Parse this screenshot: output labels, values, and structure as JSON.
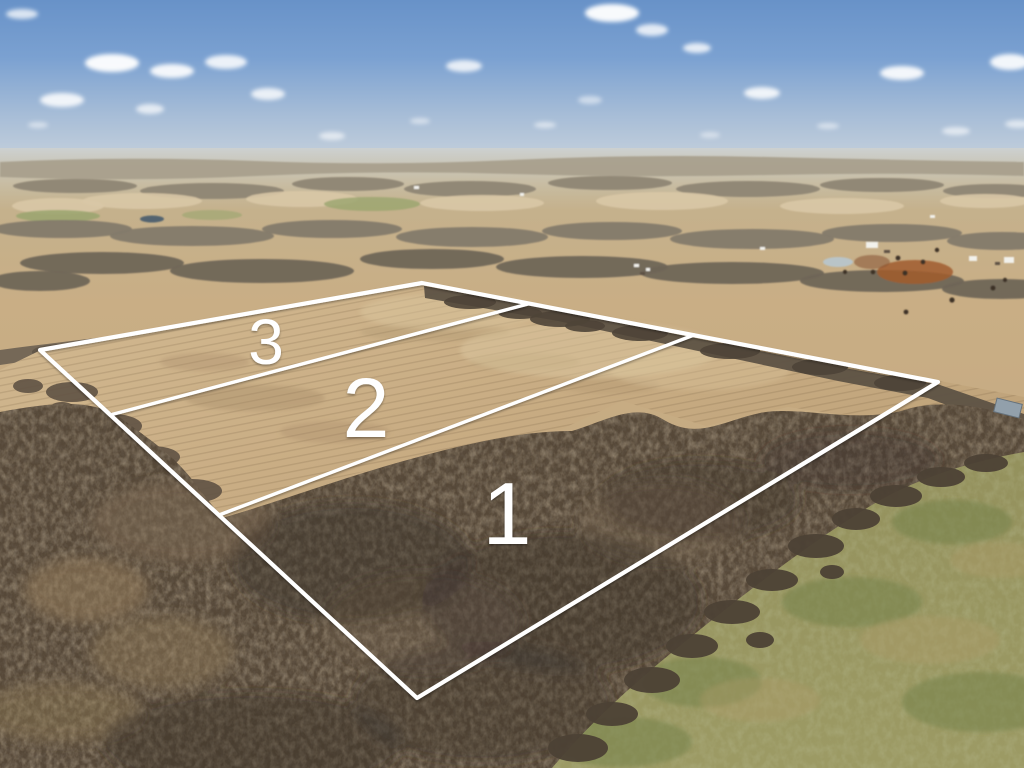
{
  "photo": {
    "kind": "aerial-drone-photograph",
    "subject": "rural farmland with surveyed lot lines marking three parcels",
    "season": "late winter, bare trees"
  },
  "overlay": {
    "line_color": "#ffffff",
    "label_color": "#ffffff",
    "outer_boundary_points": "40,350 422,283 938,382 417,698",
    "divider_3_2_points": "110,415 528,304",
    "divider_2_1_points": "219,515 694,335",
    "lots": [
      {
        "label": "1",
        "terrain": "wooded",
        "label_x": "507",
        "label_y": "544",
        "font_size": "88"
      },
      {
        "label": "2",
        "terrain": "open field",
        "label_x": "366",
        "label_y": "437",
        "font_size": "84"
      },
      {
        "label": "3",
        "terrain": "open field",
        "label_x": "266",
        "label_y": "364",
        "font_size": "64"
      }
    ]
  },
  "scene": {
    "sky_top": "#6892c8",
    "sky_horizon": "#c8d2dc",
    "haze": "#cdd2d4",
    "distant_field": "#cbb795",
    "distant_woods": "#948b7a",
    "field_tan": "#c7ac85",
    "field_streak": "#6a5439",
    "forest_dark": "#564838",
    "forest_light": "#7c6a52",
    "pasture_green": "#94915d",
    "pond": "#b9c4c8",
    "lake": "#52636f",
    "dirt_red": "#a15c2e",
    "clouds": [
      [
        22,
        14,
        16,
        5,
        0.75
      ],
      [
        112,
        63,
        27,
        9,
        0.95
      ],
      [
        172,
        71,
        22,
        7,
        0.9
      ],
      [
        226,
        62,
        21,
        7,
        0.85
      ],
      [
        268,
        94,
        17,
        6,
        0.8
      ],
      [
        62,
        100,
        22,
        7,
        0.85
      ],
      [
        150,
        109,
        14,
        5,
        0.7
      ],
      [
        38,
        125,
        10,
        3,
        0.5
      ],
      [
        332,
        136,
        13,
        4,
        0.6
      ],
      [
        420,
        121,
        10,
        3,
        0.5
      ],
      [
        464,
        66,
        18,
        6,
        0.8
      ],
      [
        545,
        125,
        11,
        3,
        0.55
      ],
      [
        612,
        13,
        27,
        9,
        0.95
      ],
      [
        652,
        30,
        16,
        6,
        0.8
      ],
      [
        697,
        48,
        14,
        5,
        0.8
      ],
      [
        762,
        93,
        18,
        6,
        0.85
      ],
      [
        828,
        126,
        11,
        3,
        0.5
      ],
      [
        902,
        73,
        22,
        7,
        0.9
      ],
      [
        956,
        131,
        14,
        4,
        0.6
      ],
      [
        1010,
        62,
        20,
        8,
        0.9
      ],
      [
        1018,
        124,
        13,
        4,
        0.6
      ],
      [
        590,
        100,
        12,
        4,
        0.5
      ],
      [
        710,
        135,
        10,
        3,
        0.45
      ]
    ]
  }
}
